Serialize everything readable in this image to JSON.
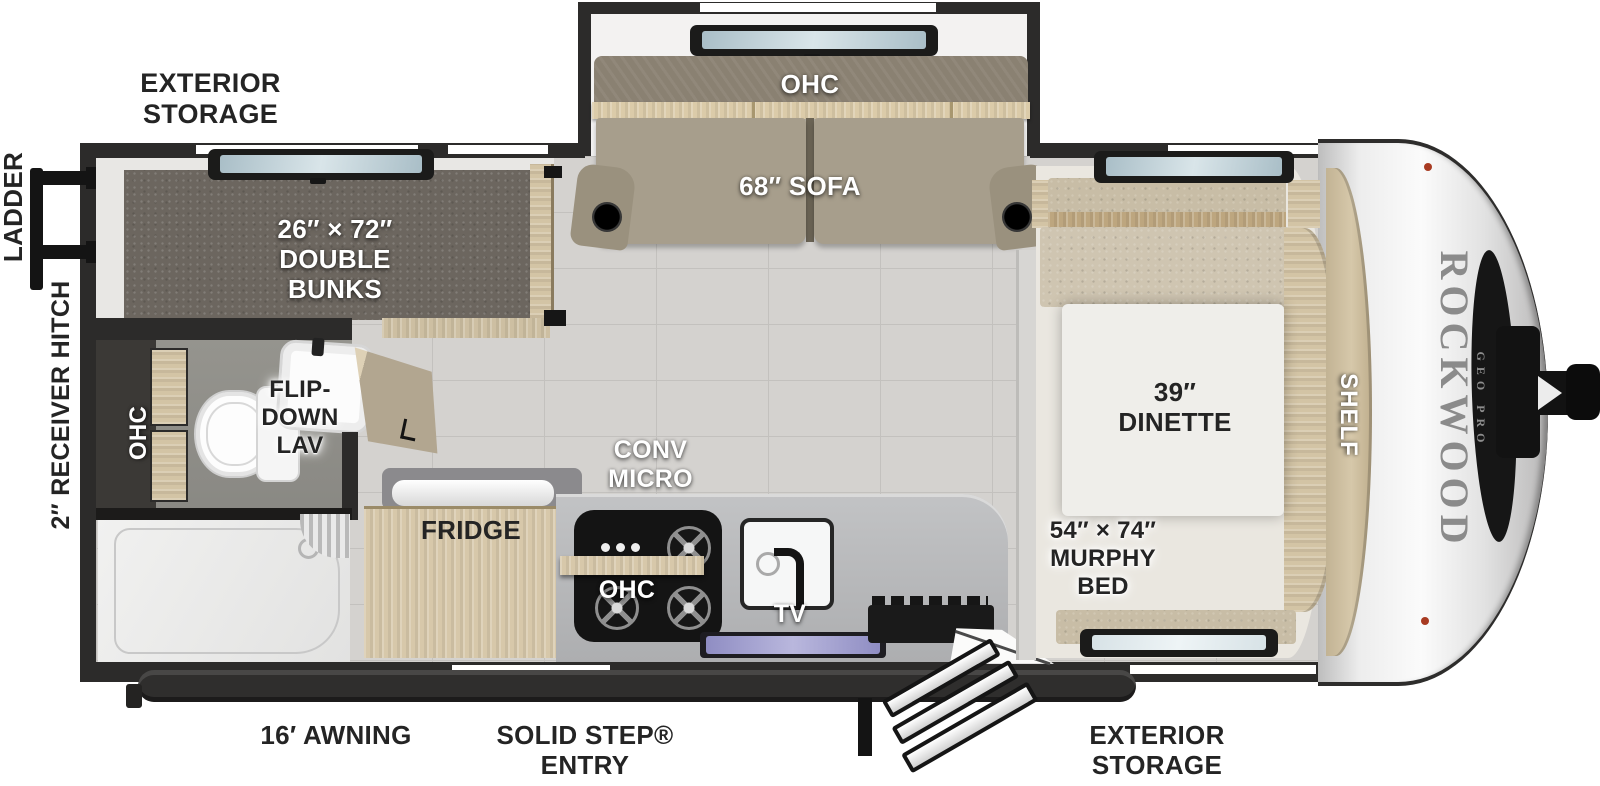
{
  "brand": {
    "name": "ROCKWOOD",
    "subname": "GEO PRO"
  },
  "labels": {
    "exterior_storage_top": "EXTERIOR\nSTORAGE",
    "exterior_storage_bottom": "EXTERIOR\nSTORAGE",
    "ladder": "LADDER",
    "receiver_hitch": "2″ RECEIVER HITCH",
    "double_bunks": "26″ × 72″\nDOUBLE\nBUNKS",
    "sofa_ohc": "OHC",
    "sofa": "68″ SOFA",
    "bath_ohc": "OHC",
    "flip_down_lav": "FLIP-\nDOWN\nLAV",
    "fridge": "FRIDGE",
    "conv_micro": "CONV\nMICRO",
    "kitchen_ohc": "OHC",
    "tv": "TV",
    "dinette": "39″\nDINETTE",
    "murphy_bed": "54″ × 74″\nMURPHY\nBED",
    "shelf": "SHELF",
    "awning": "16′ AWNING",
    "entry": "SOLID STEP®\nENTRY"
  },
  "colors": {
    "wall": "#2c2b2a",
    "floor": "#d4d2cf",
    "wood": "#d7c8aa",
    "upholstery": "#a79e8c",
    "carpet": "#6c665f",
    "marker_light": "#a83b22"
  }
}
